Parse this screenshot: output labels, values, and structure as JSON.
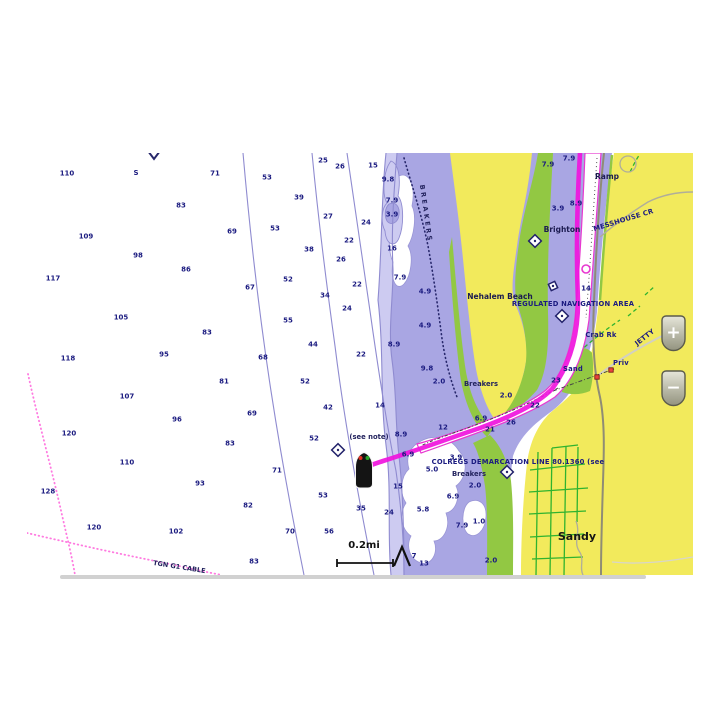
{
  "map": {
    "scale_label": "0.2mi",
    "colors": {
      "land_yellow": "#f2ea5c",
      "shallow_green": "#92c843",
      "shallow_lavender": "#a9a6e3",
      "fringe_lavender": "#cdcbf1",
      "route_magenta": "#f013dd",
      "channel_edge_magenta": "#e838d0",
      "cable_pink": "#ff7ae0",
      "sounding_navy": "#1b1b80",
      "contour_purple": "#8f8bd0"
    },
    "labels": [
      {
        "t": "S",
        "x": 136,
        "y": 175,
        "c": "snd"
      },
      {
        "t": "BREAKERS",
        "x": 424,
        "y": 214,
        "c": "vert",
        "r": 82
      },
      {
        "t": "(see note)",
        "x": 369,
        "y": 439,
        "c": "note"
      },
      {
        "t": "Breakers",
        "x": 481,
        "y": 386,
        "c": "note"
      },
      {
        "t": "Breakers",
        "x": 469,
        "y": 476,
        "c": "note"
      },
      {
        "t": "Nehalem Beach",
        "x": 500,
        "y": 299,
        "c": "place"
      },
      {
        "t": "Brighton",
        "x": 562,
        "y": 232,
        "c": "place"
      },
      {
        "t": "Ramp",
        "x": 607,
        "y": 179,
        "c": "place"
      },
      {
        "t": "MESSHOUSE CR",
        "x": 624,
        "y": 222,
        "c": "nav",
        "r": -17
      },
      {
        "t": "REGULATED NAVIGATION AREA",
        "x": 573,
        "y": 306,
        "c": "nav",
        "a": "start"
      },
      {
        "t": "Crab Rk",
        "x": 601,
        "y": 337,
        "c": "nav"
      },
      {
        "t": "Sand",
        "x": 573,
        "y": 371,
        "c": "nav"
      },
      {
        "t": "Priv",
        "x": 621,
        "y": 365,
        "c": "nav"
      },
      {
        "t": "JETTY",
        "x": 646,
        "y": 339,
        "c": "nav",
        "r": -38
      },
      {
        "t": "COLREGS DEMARCATION LINE 80.1360 (see",
        "x": 518,
        "y": 464,
        "c": "nav",
        "a": "start"
      },
      {
        "t": "Sandy",
        "x": 577,
        "y": 540,
        "c": "city"
      },
      {
        "t": "TGN G1 CABLE",
        "x": 179,
        "y": 569,
        "c": "cable",
        "r": 9
      },
      {
        "t": "7",
        "x": 414,
        "y": 558,
        "c": "snd"
      }
    ],
    "soundings": [
      [
        "110",
        67,
        173
      ],
      [
        "71",
        215,
        173
      ],
      [
        "83",
        181,
        205
      ],
      [
        "109",
        86,
        236
      ],
      [
        "69",
        232,
        231
      ],
      [
        "98",
        138,
        255
      ],
      [
        "86",
        186,
        269
      ],
      [
        "117",
        53,
        278
      ],
      [
        "105",
        121,
        317
      ],
      [
        "83",
        207,
        332
      ],
      [
        "95",
        164,
        354
      ],
      [
        "118",
        68,
        358
      ],
      [
        "81",
        224,
        381
      ],
      [
        "107",
        127,
        396
      ],
      [
        "96",
        177,
        419
      ],
      [
        "120",
        69,
        433
      ],
      [
        "83",
        230,
        443
      ],
      [
        "110",
        127,
        462
      ],
      [
        "93",
        200,
        483
      ],
      [
        "128",
        48,
        491
      ],
      [
        "120",
        94,
        527
      ],
      [
        "102",
        176,
        531
      ],
      [
        "83",
        254,
        561
      ],
      [
        "82",
        248,
        505
      ],
      [
        "70",
        290,
        531
      ],
      [
        "71",
        277,
        470
      ],
      [
        "69",
        252,
        413
      ],
      [
        "68",
        263,
        357
      ],
      [
        "67",
        250,
        287
      ],
      [
        "52",
        288,
        279
      ],
      [
        "55",
        288,
        320
      ],
      [
        "44",
        313,
        344
      ],
      [
        "53",
        275,
        228
      ],
      [
        "53",
        267,
        177
      ],
      [
        "39",
        299,
        197
      ],
      [
        "38",
        309,
        249
      ],
      [
        "34",
        325,
        295
      ],
      [
        "25",
        323,
        160
      ],
      [
        "26",
        340,
        166
      ],
      [
        "15",
        373,
        165
      ],
      [
        "27",
        328,
        216
      ],
      [
        "24",
        366,
        222
      ],
      [
        "22",
        349,
        240
      ],
      [
        "26",
        341,
        259
      ],
      [
        "22",
        357,
        284
      ],
      [
        "24",
        347,
        308
      ],
      [
        "22",
        361,
        354
      ],
      [
        "52",
        305,
        381
      ],
      [
        "42",
        328,
        407
      ],
      [
        "52",
        314,
        438
      ],
      [
        "53",
        323,
        495
      ],
      [
        "35",
        361,
        508
      ],
      [
        "24",
        389,
        512
      ],
      [
        "56",
        329,
        531
      ],
      [
        "14",
        380,
        405
      ],
      [
        "12",
        443,
        427
      ],
      [
        "21",
        490,
        429
      ],
      [
        "26",
        511,
        422
      ],
      [
        "22",
        535,
        405
      ],
      [
        "23",
        556,
        380
      ],
      [
        "14",
        586,
        288
      ],
      [
        "16",
        392,
        248
      ],
      [
        "13",
        424,
        563
      ],
      [
        "9.8",
        388,
        179
      ],
      [
        "7.9",
        392,
        200
      ],
      [
        "3.9",
        392,
        214
      ],
      [
        "7.9",
        400,
        277
      ],
      [
        "8.9",
        394,
        344
      ],
      [
        "8.9",
        401,
        434
      ],
      [
        "4.9",
        425,
        291
      ],
      [
        "4.9",
        425,
        325
      ],
      [
        "9.8",
        427,
        368
      ],
      [
        "2.0",
        439,
        381
      ],
      [
        "2.0",
        506,
        395
      ],
      [
        "6.9",
        481,
        418
      ],
      [
        "7.9",
        548,
        164
      ],
      [
        "7.9",
        569,
        158
      ],
      [
        "3.9",
        558,
        208
      ],
      [
        "8.9",
        576,
        203
      ],
      [
        "3.9",
        456,
        457
      ],
      [
        "5.0",
        432,
        469
      ],
      [
        "6.9",
        408,
        454
      ],
      [
        "15",
        398,
        486
      ],
      [
        "6.9",
        453,
        496
      ],
      [
        "5.8",
        423,
        509
      ],
      [
        "2.0",
        475,
        485
      ],
      [
        "7.9",
        462,
        525
      ],
      [
        "1.0",
        479,
        521
      ],
      [
        "2.0",
        491,
        560
      ]
    ],
    "diamonds": [
      {
        "x": 338,
        "y": 450,
        "s": 9
      },
      {
        "x": 535,
        "y": 241,
        "s": 9
      },
      {
        "x": 553,
        "y": 286,
        "s": 7,
        "rot": 20
      },
      {
        "x": 562,
        "y": 316,
        "s": 9
      },
      {
        "x": 507,
        "y": 472,
        "s": 9
      }
    ],
    "beacons": [
      [
        597,
        377
      ],
      [
        611,
        370
      ]
    ]
  },
  "controls": {
    "zoom_in_label": "+",
    "zoom_out_label": "−"
  }
}
